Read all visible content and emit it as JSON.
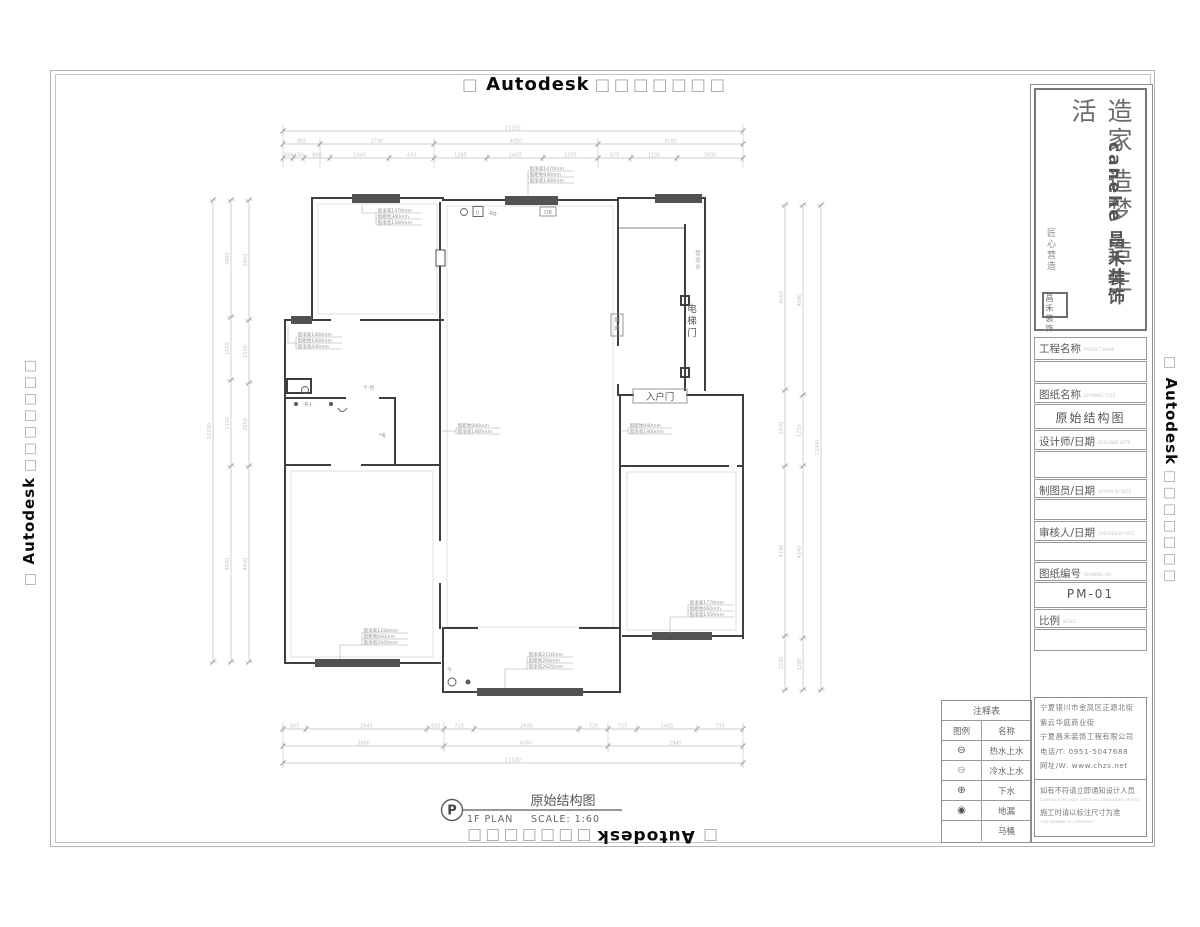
{
  "watermark": {
    "prefix": "□",
    "brand": "Autodesk",
    "suffix": "□□□□□□□"
  },
  "logo": {
    "slogan": "造家 造梦 造生活",
    "brand_en": "canehe",
    "brand_cn": "昌禾装饰",
    "signature": "匠心营造",
    "seal": "昌禾装饰"
  },
  "title_block": {
    "fields": [
      {
        "t": "label",
        "text": "工程名称",
        "sub": "PROJECT NAME",
        "h": 23
      },
      {
        "t": "value",
        "text": "",
        "h": 21
      },
      {
        "t": "label",
        "text": "图纸名称",
        "sub": "DRAWING TITLE",
        "h": 20
      },
      {
        "t": "value",
        "text": "原始结构图",
        "h": 25
      },
      {
        "t": "label",
        "text": "设计师/日期",
        "sub": "DESIGNER DATE",
        "h": 20
      },
      {
        "t": "value",
        "text": "",
        "h": 27
      },
      {
        "t": "label",
        "text": "制图员/日期",
        "sub": "DRAWN BY DATE",
        "h": 19
      },
      {
        "t": "value",
        "text": "",
        "h": 21
      },
      {
        "t": "label",
        "text": "审核人/日期",
        "sub": "CHECKED BY DATE",
        "h": 20
      },
      {
        "t": "value",
        "text": "",
        "h": 19
      },
      {
        "t": "label",
        "text": "图纸编号",
        "sub": "DRAWING NO.",
        "h": 19
      },
      {
        "t": "value",
        "text": "PM-01",
        "h": 26
      },
      {
        "t": "label",
        "text": "比例",
        "sub": "SCALE:",
        "h": 19
      },
      {
        "t": "value",
        "text": "",
        "h": 22
      }
    ]
  },
  "company": {
    "address1": "宁夏银川市金凤区正源北街",
    "address2": "紫云华庭商业街",
    "name": "宁夏昌禾装饰工程有限公司",
    "phone": "电话/T: 0951-5047688",
    "website": "网址/W: www.chzs.net",
    "notice1_cn": "如有不符请立即通知设计人员",
    "notice1_en": "CONTRACTORS MUST CHECK ALL DIMENSIONS ON SITE",
    "notice2_cn": "施工时请以标注尺寸为准",
    "notice2_en": "THIS DRAWING IS COPYRIGHT"
  },
  "legend": {
    "title": "注释表",
    "headers": [
      "图例",
      "名称"
    ],
    "rows": [
      {
        "symbol": "⊖",
        "name": "热水上水"
      },
      {
        "symbol": "⊖",
        "name": "冷水上水"
      },
      {
        "symbol": "⊕",
        "name": "下水"
      },
      {
        "symbol": "◉",
        "name": "地漏"
      },
      {
        "symbol": "",
        "name": "马桶"
      }
    ]
  },
  "plan_title": {
    "tag": "P",
    "name_cn": "原始结构图",
    "floor": "1F PLAN",
    "scale": "SCALE: 1:60"
  },
  "plan": {
    "labels": {
      "entry_door": "入户门",
      "elevator_door": "电梯门",
      "flue": "烟道",
      "shaft": "管道井",
      "d_tag": "D8",
      "symbol_rg": "-Rg-",
      "symbol_o": "O",
      "symbol_rj": "-R-J-",
      "symbol_gz": "个-甘",
      "symbol_dong": "*冬",
      "symbol_jin": "今"
    },
    "window_annotations": [
      {
        "x": 376,
        "y": 213,
        "w": 46,
        "lines": [
          "窗净高1470mm",
          "窗距地340mm",
          "窗净宽1440mm"
        ],
        "leader": "M376,213 H362 V205"
      },
      {
        "x": 528,
        "y": 171,
        "w": 46,
        "lines": [
          "窗净高1470mm",
          "窗距地940mm",
          "窗净宽1400mm"
        ],
        "leader": "M528,183 V197"
      },
      {
        "x": 296,
        "y": 337,
        "w": 46,
        "lines": [
          "窗净高1400mm",
          "窗距地1000mm",
          "窗净宽430mm"
        ],
        "leader": "M296,343 H288 V325"
      },
      {
        "x": 456,
        "y": 428,
        "w": 44,
        "lines": [
          "窗距地940mm",
          "窗净宽1460mm"
        ],
        "leader": "M456,431 H442"
      },
      {
        "x": 628,
        "y": 428,
        "w": 44,
        "lines": [
          "窗距地940mm",
          "窗净宽1400mm"
        ],
        "leader": "M628,431 H622"
      },
      {
        "x": 362,
        "y": 633,
        "w": 46,
        "lines": [
          "窗净高1220mm",
          "窗距地660mm",
          "窗净宽2045mm"
        ],
        "leader": "M362,645 H340 V659"
      },
      {
        "x": 527,
        "y": 657,
        "w": 46,
        "lines": [
          "窗净高2150mm",
          "窗距地200mm",
          "窗净宽2625mm"
        ],
        "leader": "M527,669 H505 V688"
      },
      {
        "x": 688,
        "y": 605,
        "w": 46,
        "lines": [
          "窗净高1770mm",
          "窗距地660mm",
          "窗净宽1450mm"
        ],
        "leader": "M688,617 H670 V633"
      }
    ],
    "dim_chains": [
      {
        "orient": "h",
        "pos": 131,
        "ticks": [
          283,
          743
        ],
        "values": [
          "11255"
        ]
      },
      {
        "orient": "h",
        "pos": 144,
        "ticks": [
          283,
          320,
          434,
          598,
          743
        ],
        "values": [
          "905",
          "2790",
          "4050",
          "3180"
        ]
      },
      {
        "orient": "h",
        "pos": 158,
        "ticks": [
          283,
          293,
          304,
          330,
          389,
          434,
          487,
          543,
          598,
          631,
          677,
          743
        ],
        "values": [
          "240",
          "430",
          "690",
          "1440",
          "430",
          "1285",
          "1400",
          "1295",
          "825",
          "1150",
          "1830"
        ]
      },
      {
        "orient": "h",
        "pos": 729,
        "ticks": [
          283,
          306,
          427,
          444,
          474,
          579,
          608,
          637,
          697,
          743
        ],
        "values": [
          "565",
          "2945",
          "420",
          "720",
          "2600",
          "720",
          "735",
          "1455",
          "735"
        ]
      },
      {
        "orient": "h",
        "pos": 746,
        "ticks": [
          283,
          444,
          608,
          743
        ],
        "values": [
          "3960",
          "4060",
          "2945"
        ]
      },
      {
        "orient": "h",
        "pos": 763,
        "ticks": [
          283,
          743
        ],
        "values": [
          "11500"
        ]
      },
      {
        "orient": "v",
        "pos": 213,
        "ticks": [
          200,
          662
        ],
        "values": [
          "11330"
        ]
      },
      {
        "orient": "v",
        "pos": 231,
        "ticks": [
          200,
          317,
          380,
          466,
          662
        ],
        "values": [
          "2880",
          "1550",
          "2120",
          "4830"
        ]
      },
      {
        "orient": "v",
        "pos": 249,
        "ticks": [
          200,
          320,
          383,
          466,
          662
        ],
        "values": [
          "2950",
          "1550",
          "2050",
          "4830"
        ]
      },
      {
        "orient": "v",
        "pos": 821,
        "ticks": [
          205,
          690
        ],
        "values": [
          "11940"
        ]
      },
      {
        "orient": "v",
        "pos": 803,
        "ticks": [
          205,
          395,
          466,
          638,
          690
        ],
        "values": [
          "4680",
          "1750",
          "4240",
          "1280"
        ]
      },
      {
        "orient": "v",
        "pos": 785,
        "ticks": [
          205,
          390,
          466,
          636,
          690
        ],
        "values": [
          "4560",
          "1870",
          "4190",
          "1330"
        ]
      }
    ]
  },
  "colors": {
    "wall": "#3f3f3f",
    "dim": "#bdbdbd",
    "annotation": "#939393",
    "watermark_box": "#a6a6a6",
    "brand_text": "#0a0a0a"
  }
}
